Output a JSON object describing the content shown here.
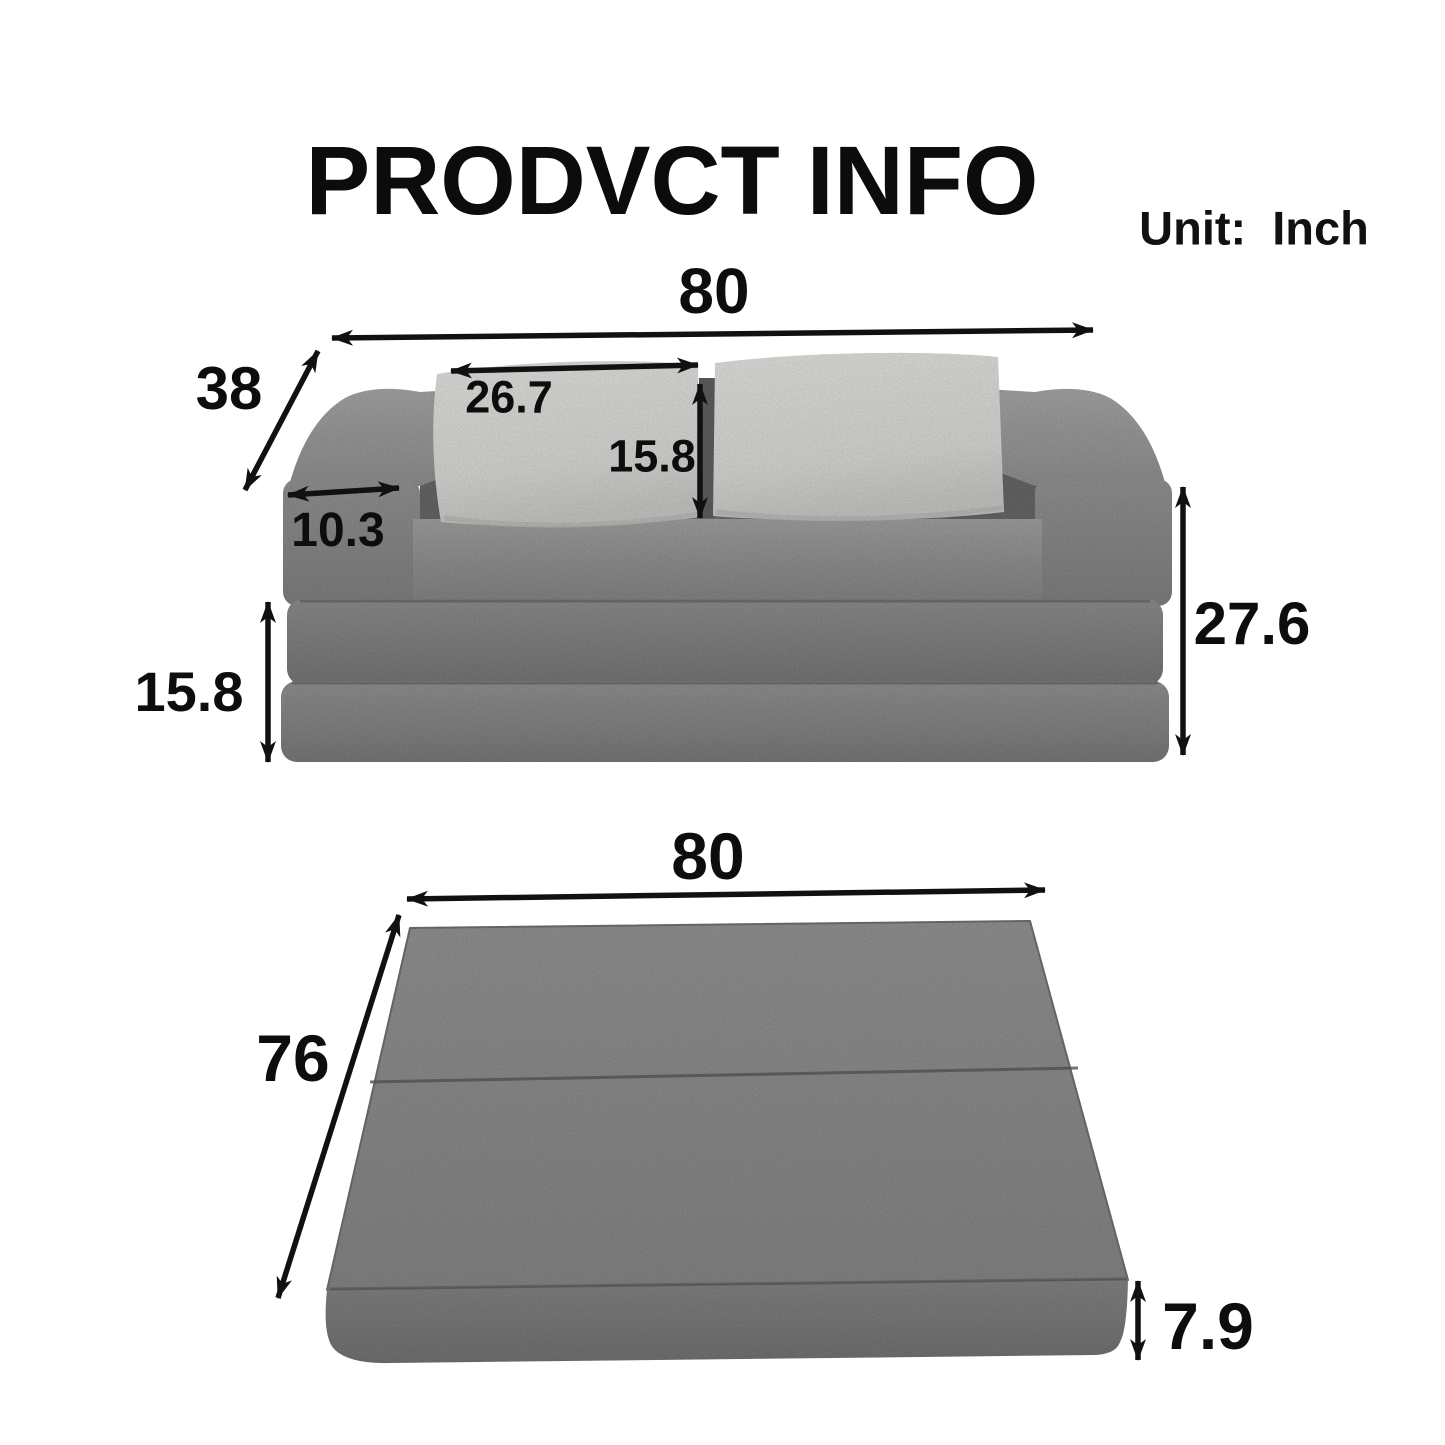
{
  "title": "PRODVCT INFO",
  "unit": {
    "label": "Unit:",
    "value": "Inch"
  },
  "sofa": {
    "width": "80",
    "depth": "38",
    "pillow_width": "26.7",
    "pillow_height": "15.8",
    "armrest_width": "10.3",
    "single_layer_height": "15.8",
    "total_height": "27.6"
  },
  "bed": {
    "width": "80",
    "depth": "76",
    "thickness": "7.9"
  },
  "colors": {
    "background": "#ffffff",
    "text": "#0d0d0d",
    "arrow": "#111111",
    "sofa_fabric": "#8a8a8a",
    "sofa_fabric_dark": "#6a6a6a",
    "mattress_fabric": "#7d7d7d",
    "pillow": "#d8d8d5"
  }
}
